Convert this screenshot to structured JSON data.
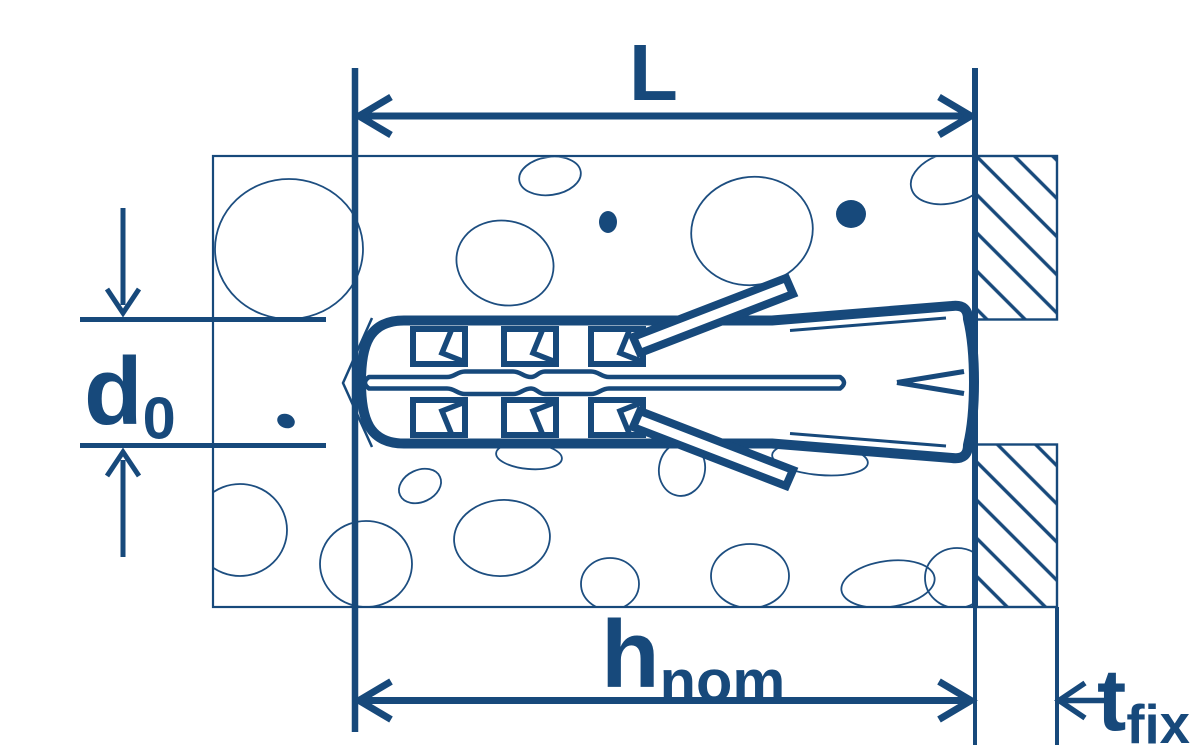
{
  "diagram": {
    "type": "technical-drawing",
    "subject": "wall-plug-anchor-installation-cross-section",
    "dimensions": {
      "length": {
        "symbol": "L",
        "sub": ""
      },
      "hole_diameter": {
        "symbol": "d",
        "sub": "0"
      },
      "nominal_embedment": {
        "symbol": "h",
        "sub": "nom"
      },
      "fixture_thickness": {
        "symbol": "t",
        "sub": "fix"
      }
    },
    "colors": {
      "ink": "#17497B",
      "background": "#ffffff"
    }
  }
}
